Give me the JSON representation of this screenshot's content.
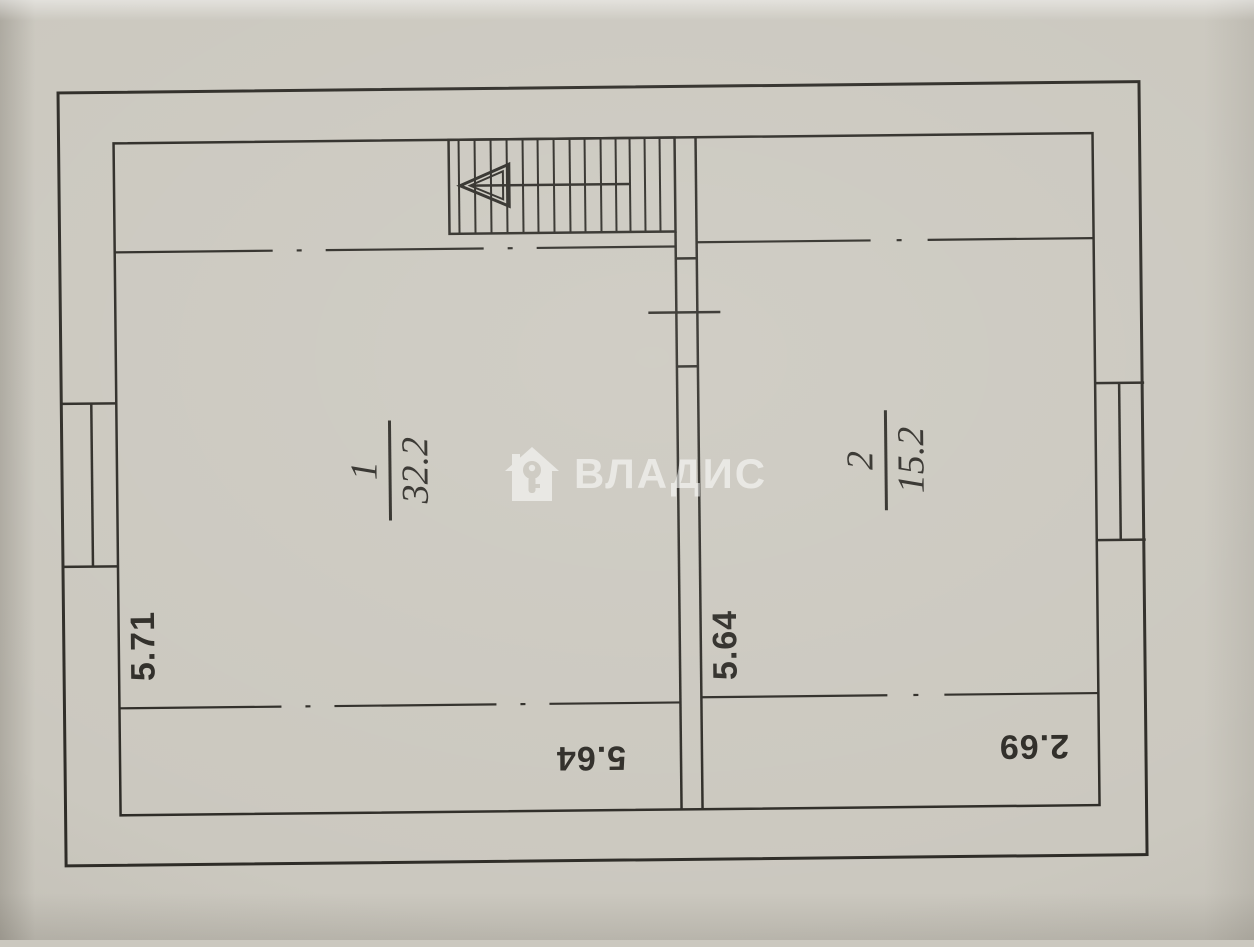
{
  "colors": {
    "paper": "#cbc8bf",
    "ink": "#2e2c27",
    "wm": "#ffffff"
  },
  "plan": {
    "rooms": [
      {
        "number": "1",
        "area": "32.2"
      },
      {
        "number": "2",
        "area": "15.2"
      }
    ],
    "dimensions": {
      "left_wall_height": "5.71",
      "partition_height": "5.64",
      "bottom_room1_width": "5.64",
      "bottom_room2_width": "2.69"
    },
    "stair": {
      "direction_icon": "left-arrow"
    },
    "watermark": {
      "logo_icon": "house-with-key",
      "brand": "ВЛАДИС"
    }
  }
}
